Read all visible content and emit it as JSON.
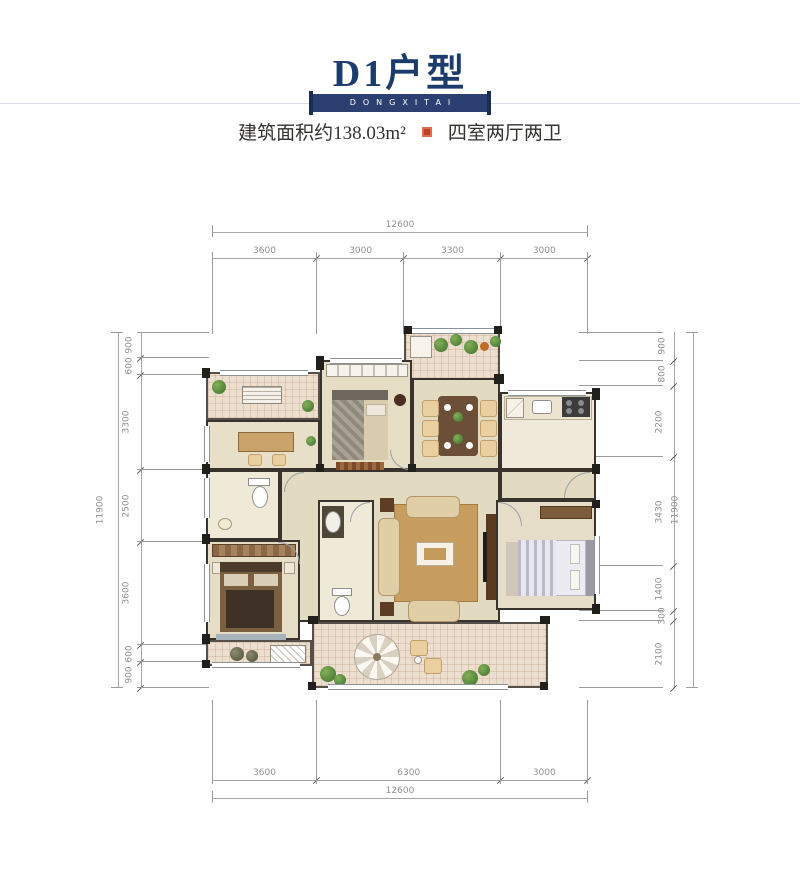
{
  "header": {
    "title": "D1户型",
    "banner_text": "DONGXITAI",
    "area_label": "建筑面积约138.03m²",
    "layout_label": "四室两厅两卫",
    "title_color": "#1d3c6e",
    "banner_bg": "#2b4070",
    "seal_color": "#bf4225"
  },
  "icons": {
    "seal": "red-square-seal",
    "plan_icons": [
      "bed",
      "dining-table",
      "sofa",
      "coffee-table",
      "tv-cabinet",
      "toilet",
      "wash-basin",
      "stove",
      "kitchen-sink",
      "fridge",
      "desk",
      "wardrobe",
      "plant",
      "parasol-table",
      "air-conditioner"
    ]
  },
  "floor_plan": {
    "type": "residential-floor-plan",
    "dimensions_mm": {
      "top": {
        "total": "12600",
        "segments": [
          "3600",
          "3000",
          "3300",
          "3000"
        ]
      },
      "bottom": {
        "total": "12600",
        "segments": [
          "3600",
          "6300",
          "3000"
        ]
      },
      "left": {
        "total": "11900",
        "segments": [
          "900",
          "600",
          "3300",
          "2500",
          "3600",
          "600",
          "900"
        ]
      },
      "right": {
        "total": "11900",
        "segments": [
          "900",
          "800",
          "2200",
          "3430",
          "1400",
          "300",
          "2100"
        ]
      }
    },
    "style": {
      "line_color": "#9a9a9a",
      "wall_color": "#211f1c",
      "floor_color": "#e7dec7"
    }
  }
}
